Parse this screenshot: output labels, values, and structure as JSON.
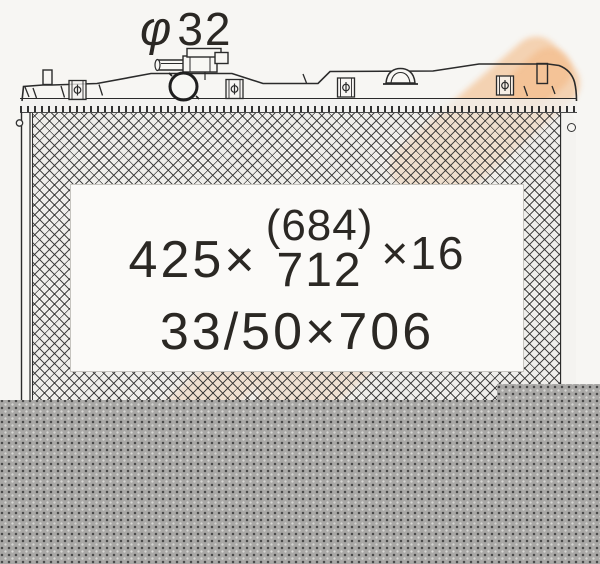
{
  "diameter_label": {
    "symbol": "φ",
    "value": "32"
  },
  "spec_box": {
    "width": "425×",
    "alt_height_paren": "(684)",
    "height": "712",
    "thickness": "×16",
    "line2": "33/50×706"
  },
  "colors": {
    "page_background": "#f7f6f3",
    "line_art": "#2b2b2b",
    "core_hatch_fill": "#eceae7",
    "watermark_peach": "#f2b178",
    "spec_box_background": "#fbfaf8",
    "redaction_gray": "#a9a8a6",
    "redaction_dot_dark": "#474747",
    "redaction_dot_light": "#d8d7d5"
  }
}
